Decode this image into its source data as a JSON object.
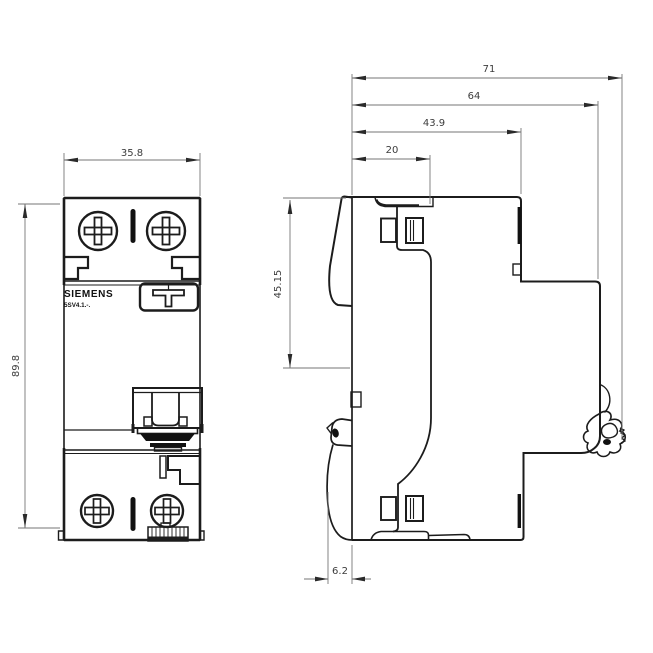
{
  "brand": "SIEMENS",
  "model": "5SV4.1.-.",
  "colors": {
    "line": "#1c1c1c",
    "dim_line": "#767676",
    "dim_text": "#3c3c3c",
    "background": "#ffffff"
  },
  "dimensions": {
    "front_width": "35.8",
    "front_height": "89.8",
    "total_depth": "71",
    "body_depth": "64",
    "front_depth": "43.9",
    "step_depth": "20",
    "face_height": "45.15",
    "rail_offset": "6.2"
  }
}
